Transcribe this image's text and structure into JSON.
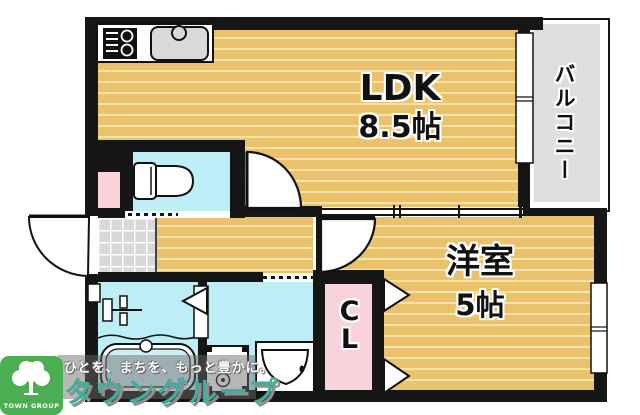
{
  "plan_type": "floor-plan",
  "rooms": {
    "ldk": {
      "label": "LDK",
      "size": "8.5帖"
    },
    "western": {
      "label": "洋室",
      "size": "5帖"
    },
    "balcony": {
      "label": "バルコニー"
    },
    "closet": {
      "label": "CL"
    }
  },
  "fixtures": [
    "stove",
    "kitchen-sink",
    "toilet",
    "bathtub",
    "shower-mixer",
    "washing-machine-pan",
    "vanity-sink",
    "entry-door",
    "ldk-door",
    "western-room-door",
    "bath-folding-door",
    "closet-folding-doors",
    "balcony-window",
    "western-room-window"
  ],
  "watermark": {
    "tagline": "ひとを、まちを、もっと豊かに。",
    "brand": "タウングループ"
  },
  "logo": {
    "name": "TOWN GROUP"
  },
  "colors": {
    "wall": "#161616",
    "wood_floor": "#e9c26b",
    "wood_stripe": "#f6e2a9",
    "wet_area": "#bdedf5",
    "closet_pink": "#f8d3da",
    "balcony_gray": "#dedede",
    "brand_teal": "#3fae9f",
    "logo_green": "#4cae52"
  }
}
